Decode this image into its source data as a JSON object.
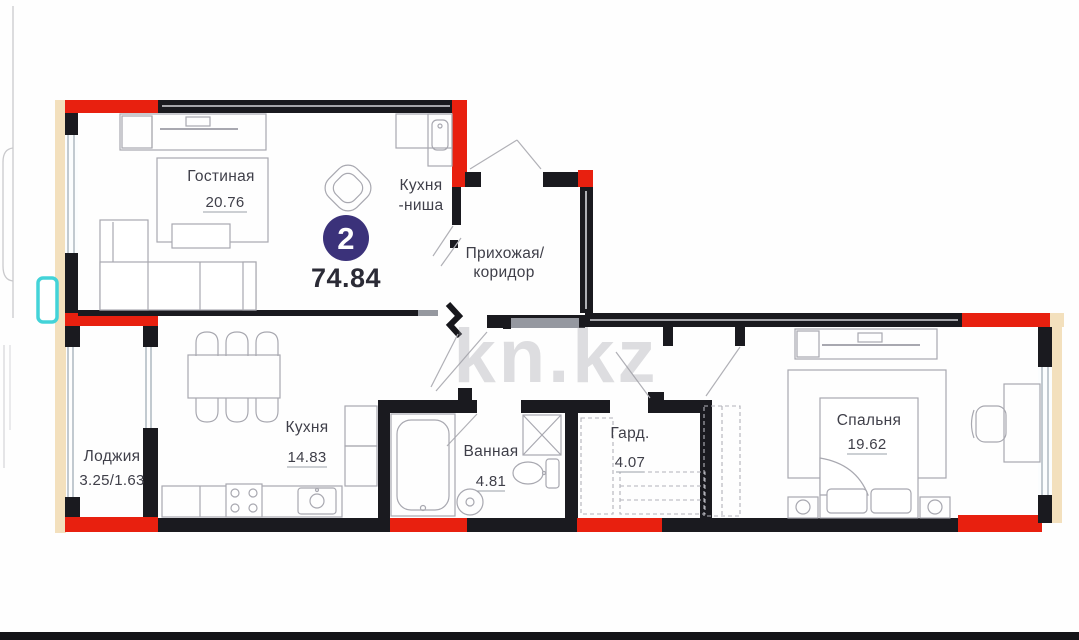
{
  "plan": {
    "badge": {
      "rooms_count": "2",
      "total_area": "74.84"
    },
    "watermark": "kn.kz",
    "colors": {
      "wall": "#1a1a1f",
      "accent_red": "#e8200f",
      "insulation_beige": "#f3e0bd",
      "marker_cyan": "#43d3d8",
      "furniture_line": "#a8a8b0",
      "label_text": "#3f3f49",
      "badge_bg": "#3b327a"
    },
    "rooms": [
      {
        "name": "Гостиная",
        "area": "20.76"
      },
      {
        "name": "Кухня",
        "name2": "-ниша"
      },
      {
        "name": "Прихожая/",
        "name2": "коридор"
      },
      {
        "name": "Лоджия",
        "area": "3.25/1.63"
      },
      {
        "name": "Кухня",
        "area": "14.83"
      },
      {
        "name": "Ванная",
        "area": "4.81"
      },
      {
        "name": "Гард.",
        "area": "4.07"
      },
      {
        "name": "Спальня",
        "area": "19.62"
      }
    ]
  }
}
